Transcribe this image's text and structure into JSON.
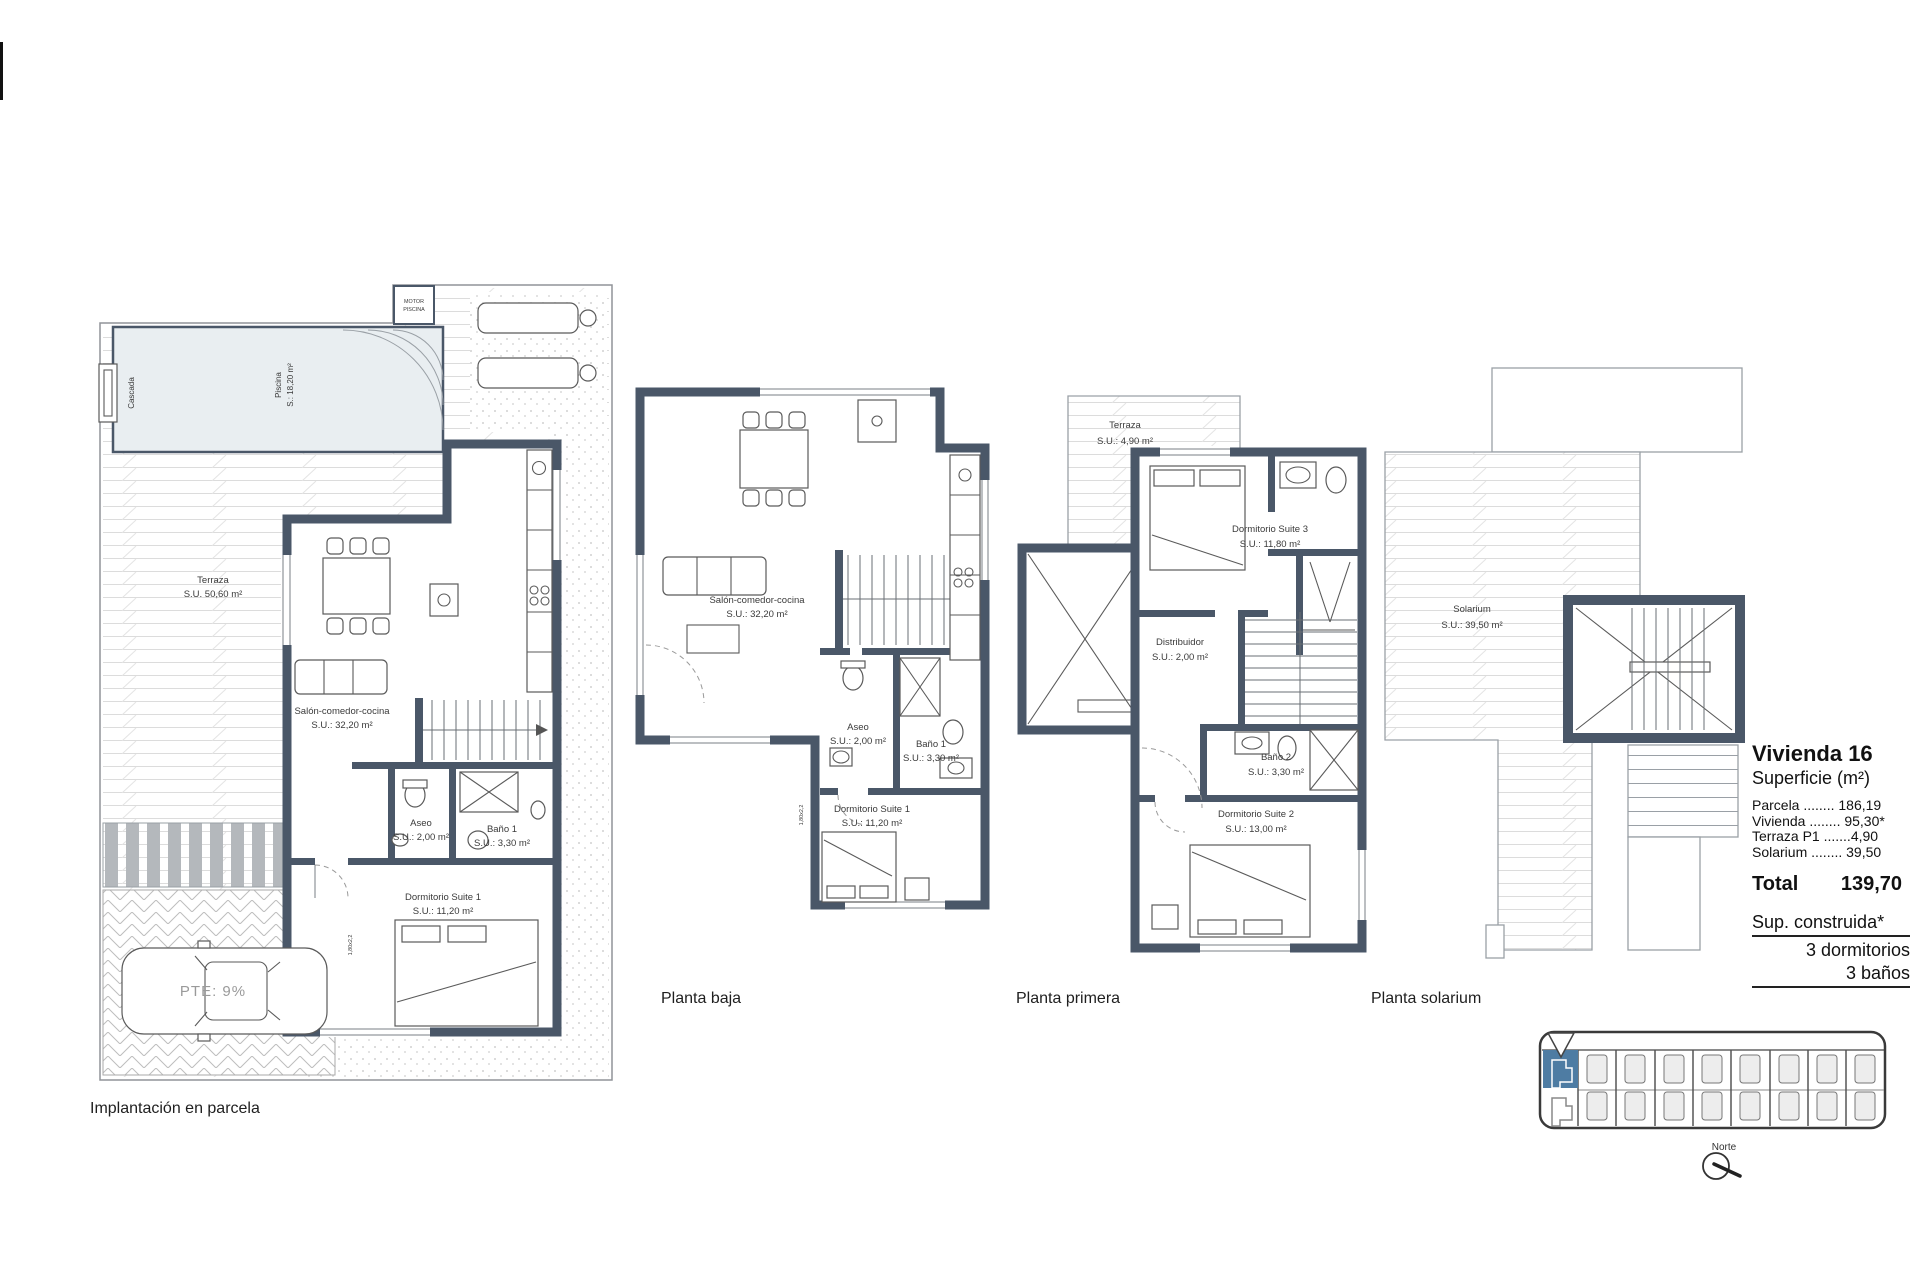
{
  "colors": {
    "wall": "#4a5768",
    "pool_fill": "#e9eef1",
    "highlight_plot": "#4e7ca3",
    "paper": "#ffffff"
  },
  "site_plan": {
    "caption": "Implantación en parcela",
    "pool": {
      "name": "Piscina",
      "area": "S.: 18,20 m²"
    },
    "cascada_label": "Cascada",
    "pump_box": {
      "line1": "MOTOR",
      "line2": "PISCINA"
    },
    "ramp_label": "PTE: 9%",
    "dim_tag": "1,80x2,2",
    "rooms": {
      "terraza": {
        "name": "Terraza",
        "area": "S.U. 50,60 m²"
      },
      "salon": {
        "name": "Salón-comedor-cocina",
        "area": "S.U.: 32,20 m²"
      },
      "aseo": {
        "name": "Aseo",
        "area": "S.U.: 2,00 m²"
      },
      "bano1": {
        "name": "Baño 1",
        "area": "S.U.: 3,30 m²"
      },
      "dorm1": {
        "name": "Dormitorio Suite 1",
        "area": "S.U.: 11,20 m²"
      }
    }
  },
  "planta_baja": {
    "caption": "Planta baja",
    "dim_tag": "1,80x2,2",
    "rooms": {
      "salon": {
        "name": "Salón-comedor-cocina",
        "area": "S.U.: 32,20 m²"
      },
      "aseo": {
        "name": "Aseo",
        "area": "S.U.: 2,00 m²"
      },
      "bano1": {
        "name": "Baño 1",
        "area": "S.U.: 3,30 m²"
      },
      "dorm1": {
        "name": "Dormitorio Suite 1",
        "area": "S.U.: 11,20 m²"
      }
    }
  },
  "planta_primera": {
    "caption": "Planta primera",
    "rooms": {
      "terraza": {
        "name": "Terraza",
        "area": "S.U.: 4,90 m²"
      },
      "dorm3": {
        "name": "Dormitorio Suite 3",
        "area": "S.U.: 11,80 m²"
      },
      "distribuidor": {
        "name": "Distribuidor",
        "area": "S.U.: 2,00 m²"
      },
      "bano2": {
        "name": "Baño 2",
        "area": "S.U.: 3,30 m²"
      },
      "dorm2": {
        "name": "Dormitorio Suite 2",
        "area": "S.U.: 13,00 m²"
      }
    }
  },
  "planta_solarium": {
    "caption": "Planta solarium",
    "rooms": {
      "solarium": {
        "name": "Solarium",
        "area": "S.U.: 39,50 m²"
      }
    }
  },
  "summary": {
    "title": "Vivienda 16",
    "subtitle": "Superficie (m²)",
    "rows": [
      "Parcela ........ 186,19",
      "Vivienda ........ 95,30*",
      "Terraza P1 .......4,90",
      "Solarium ........ 39,50"
    ],
    "total_label": "Total",
    "total_value": "139,70",
    "footnote": "Sup. construida*",
    "bedrooms": "3 dormitorios",
    "bathrooms": "3 baños"
  },
  "locator": {
    "north_label": "Norte"
  }
}
